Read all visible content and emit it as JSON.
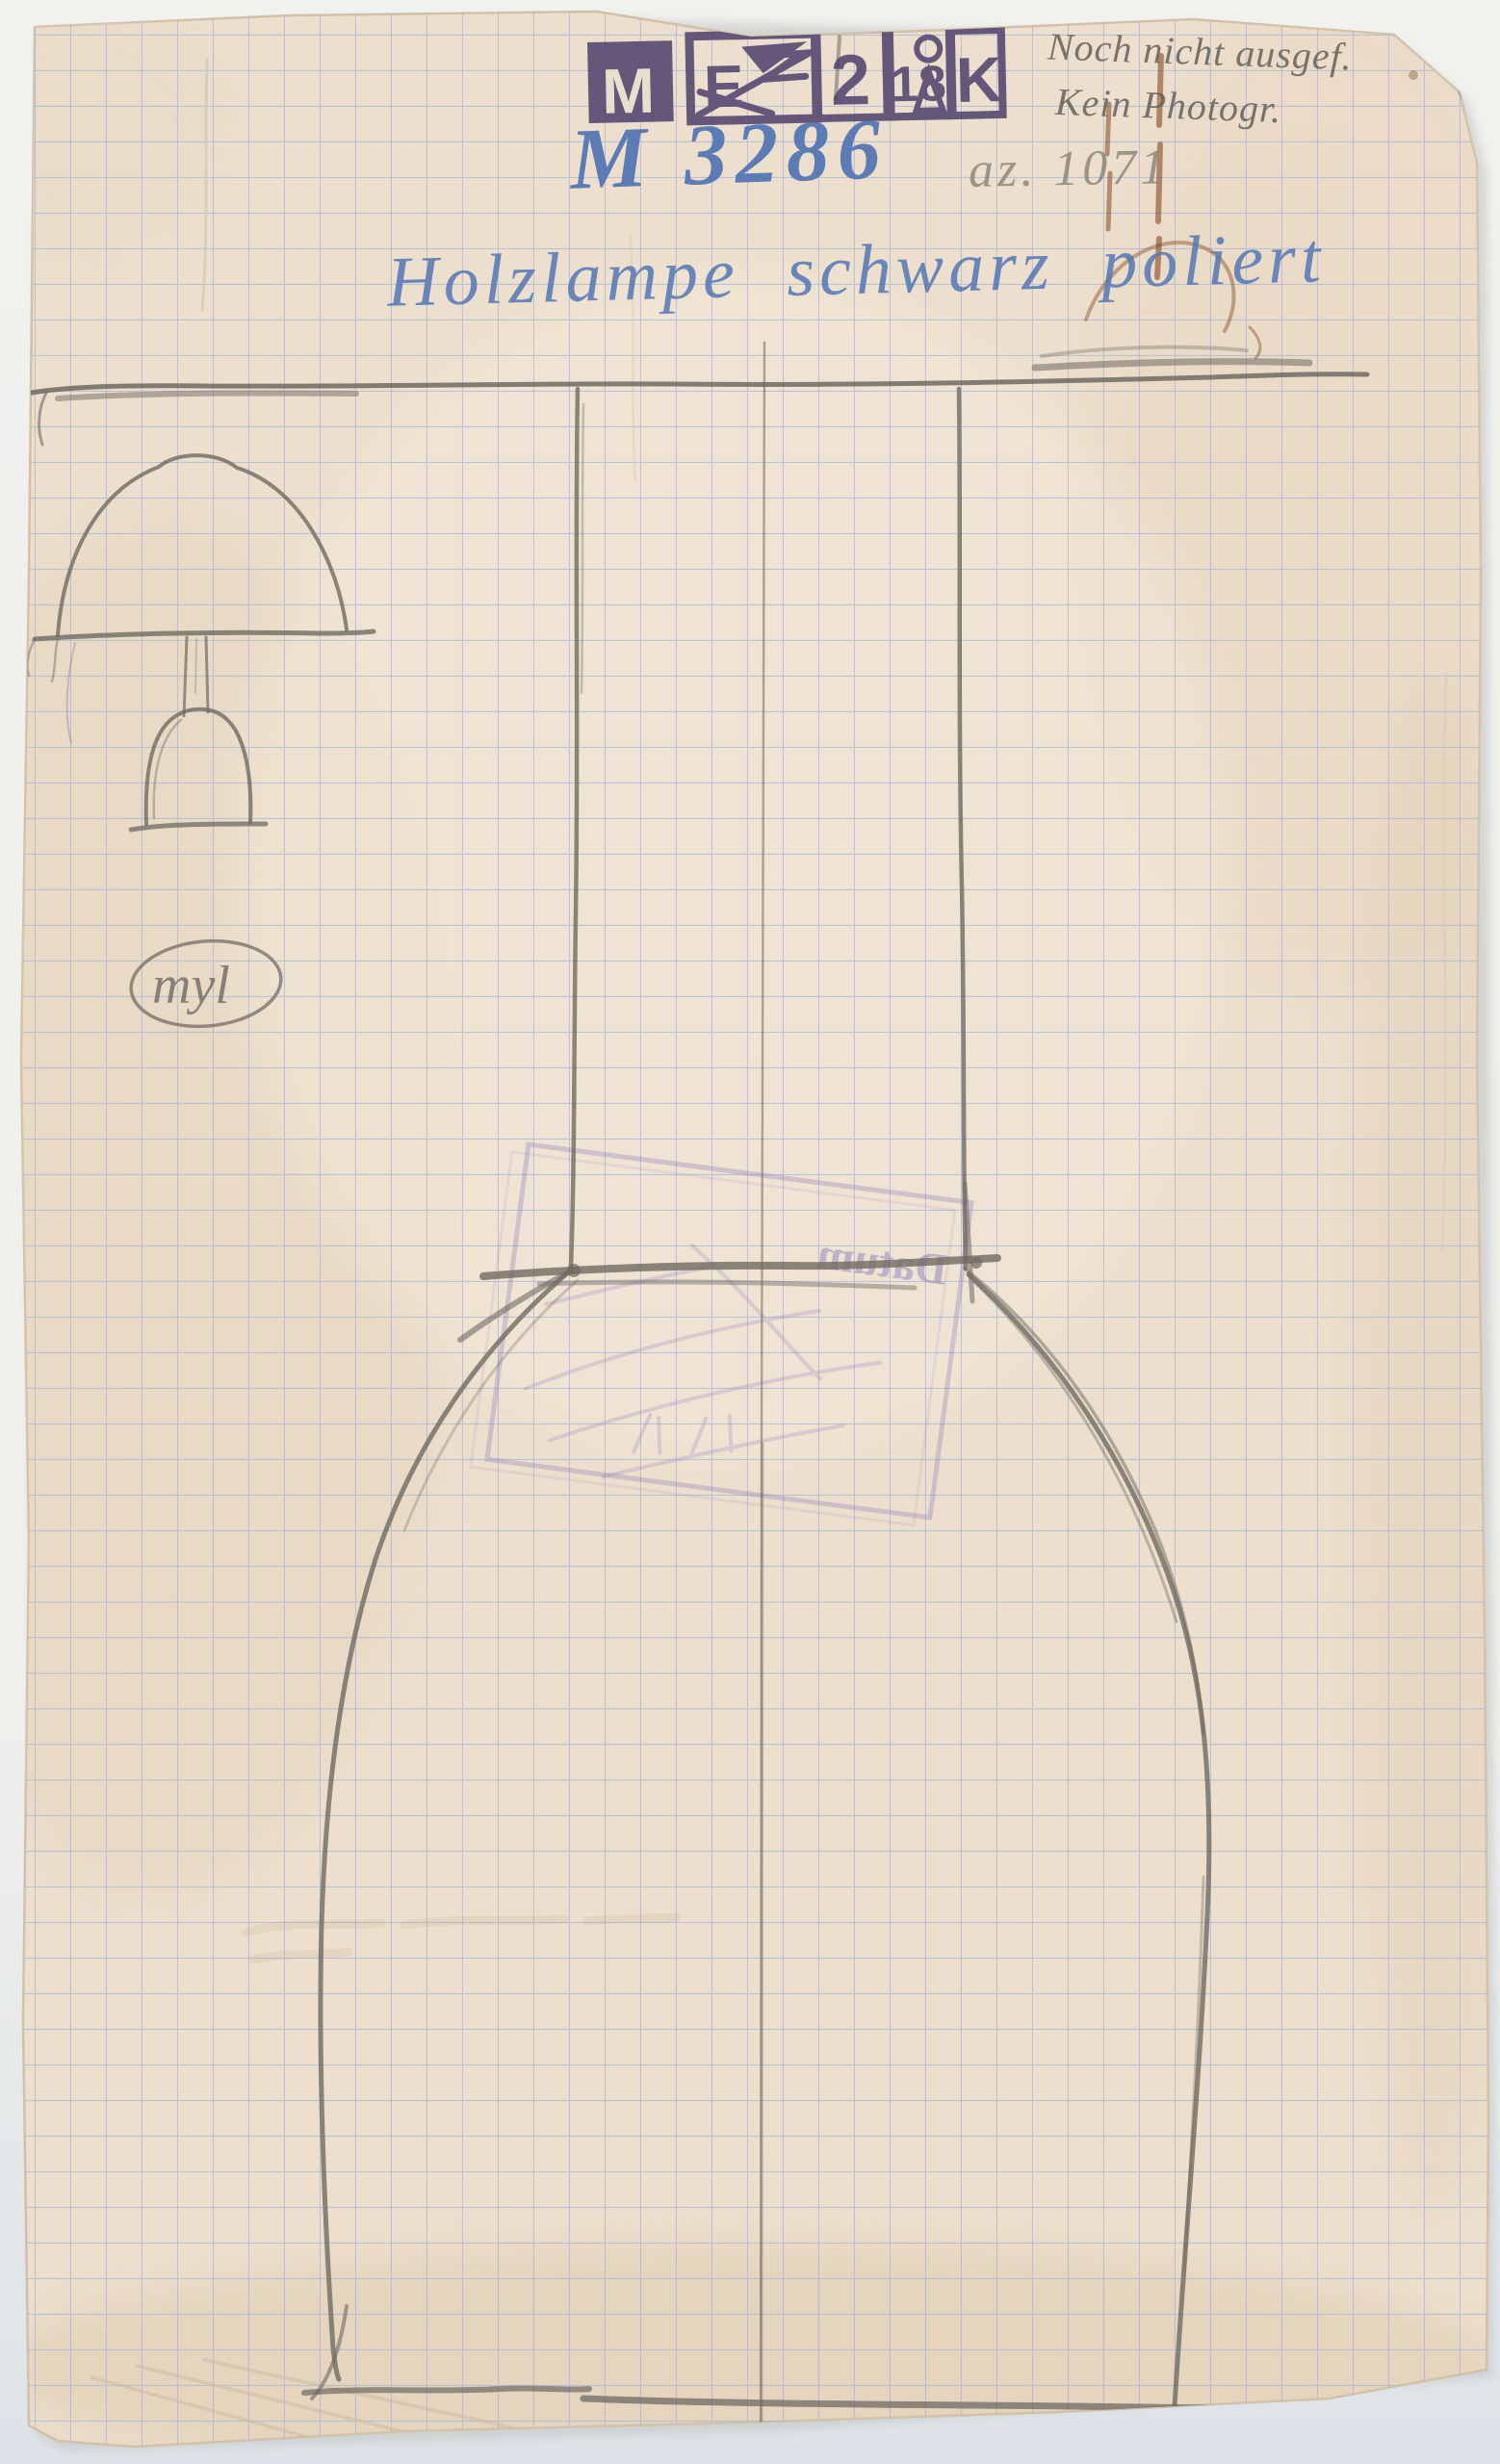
{
  "inscriptions": {
    "inventory_number": "M 3286",
    "az_number": "az. 1071",
    "note_line1": "Noch nicht ausgef.",
    "note_line2": "Kein Photogr.",
    "title": "Holzlampe schwarz poliert",
    "monogram": "myl"
  },
  "stamps": {
    "top_blocks": [
      "M",
      "E",
      "2",
      "18",
      "K"
    ],
    "bleed_word": "Datum"
  },
  "colors": {
    "paper": "#ecdfcd",
    "grid_blue": "#a9b4d6",
    "stamp_purple": "#52456e",
    "ink_blue": "#4e72b3",
    "title_blue": "#5477b6",
    "pencil": "#6f6a62",
    "bleed_purple": "#8677b5",
    "rust": "#7c3c14"
  }
}
